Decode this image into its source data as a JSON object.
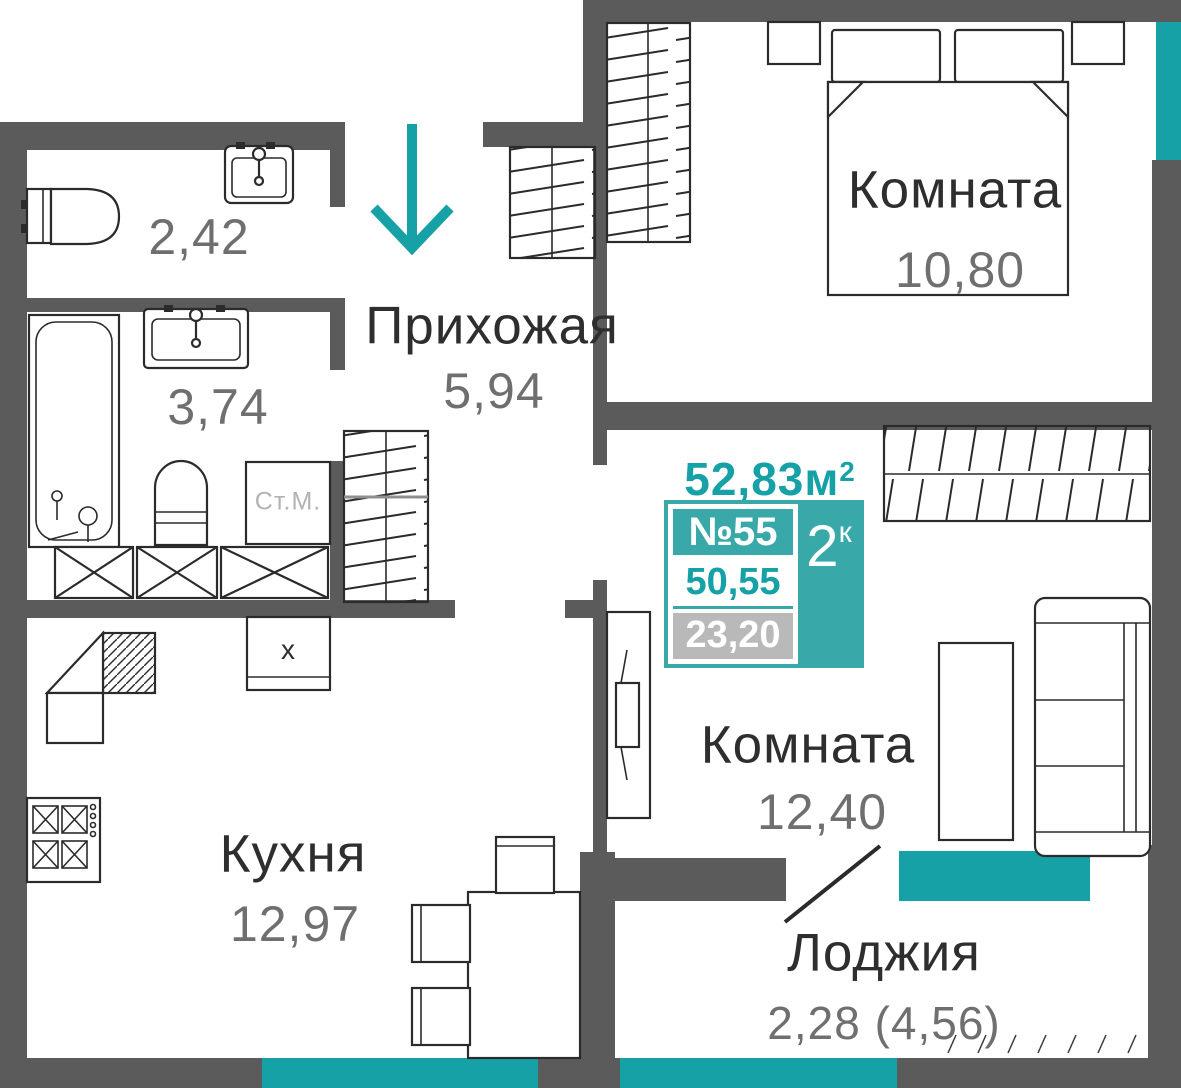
{
  "theme": {
    "wall_color": "#5b5b5b",
    "accent_color": "#16a1a7",
    "accent_soft_color": "#38a8a9",
    "text_dark_color": "#2e2e2e",
    "text_gray_color": "#6f6f6f",
    "muted_bg_color": "#b9b9b9",
    "muted_text_color": "#b3b3b3"
  },
  "rooms": {
    "wc": {
      "area": "2,42"
    },
    "bathroom": {
      "area": "3,74"
    },
    "hallway": {
      "name": "Прихожая",
      "area": "5,94"
    },
    "bedroom": {
      "name": "Комната",
      "area": "10,80"
    },
    "living": {
      "name": "Комната",
      "area": "12,40"
    },
    "kitchen": {
      "name": "Кухня",
      "area": "12,97"
    },
    "loggia": {
      "name": "Лоджия",
      "area": "2,28 (4,56)"
    }
  },
  "labels": {
    "washer": "Ст.М.",
    "kitchen_unit": "x"
  },
  "info_card": {
    "total_area": "52,83м",
    "total_area_sup": "2",
    "apartment_number": "№55",
    "rooms_count": "2",
    "rooms_count_sup": "к",
    "living_area": "50,55",
    "secondary_area": "23,20"
  }
}
